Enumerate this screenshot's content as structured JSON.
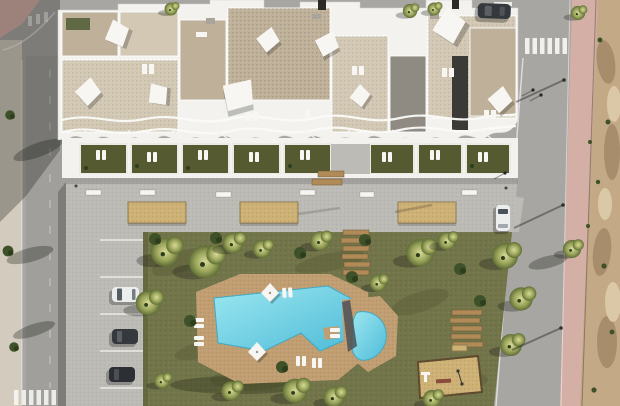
{
  "meta": {
    "type": "aerial-architectural-render",
    "caption": "Aerial 3D render of a new-build apartment complex: roof terraces with white shade sails, ground-floor private gardens, promenade, communal lawn with swimming pool and children's pool, street parking and surrounding streets beside an undeveloped rocky plot",
    "image_width": 620,
    "image_height": 406
  },
  "palette": {
    "road": "#a8a6a2",
    "sidewalk-light": "#d3ccbe",
    "sidewalk-pink": "#d4afa6",
    "dirt": "#c4a987",
    "dirt-dark": "#a78d6c",
    "dirt-light": "#dbc8a7",
    "building-white": "#f3f2ef",
    "gravel-light": "#d2c8b4",
    "gravel-mid": "#bfb199",
    "roof-gray": "#8f8b82",
    "block-dark": "#3b3a36",
    "plaza": "#bdbbb6",
    "terrace-lawn": "#555a31",
    "grass": "#72754a",
    "grass-dark": "#5e6138",
    "pool-deck": "#c19e72",
    "pool-a": "#9ce7f0",
    "pool-b": "#4fbcd8",
    "sand": "#cdb175",
    "wood": "#b08a57",
    "white-furniture": "#f7f6f2",
    "palm-a": "#d8da97",
    "palm-b": "#9aa45a",
    "palm-c": "#5f6e37",
    "bush": "#3f5128",
    "bush-dark": "#2e3d1c",
    "car-white": "#eceded",
    "car-dark": "#35393d",
    "line-white": "#eceae4",
    "shadow": "rgba(25,26,22,0.30)"
  },
  "scene": {
    "building": {
      "label": "apartment block with gravel roof terraces",
      "shade_sails": 9,
      "roof_panels": 10
    },
    "terrace_row": {
      "label": "ground-floor private gardens",
      "count": 8,
      "loungers_per_garden": 2
    },
    "plaza": {
      "label": "communal promenade",
      "sand_beds": 3,
      "benches": 6
    },
    "parking": {
      "label": "street parking bays",
      "bays": 5,
      "parked_cars": 3
    },
    "garden": {
      "label": "communal lawn",
      "palm_clusters": 15,
      "wooden_step_groups": 2
    },
    "main_pool": {
      "label": "communal swimming pool",
      "parasols": 2,
      "sun_loungers": 12
    },
    "kids_pool": {
      "label": "children's pool"
    },
    "fitness_area": {
      "label": "outdoor fitness / play corner"
    },
    "streets": {
      "left": "street with sidewalk",
      "top": "street with palm trees",
      "right": "street with pink tiled sidewalk"
    },
    "crosswalks": 3,
    "street_cars": 2,
    "streetlights": 3,
    "vacant_lot": {
      "label": "undeveloped rocky plot"
    }
  }
}
